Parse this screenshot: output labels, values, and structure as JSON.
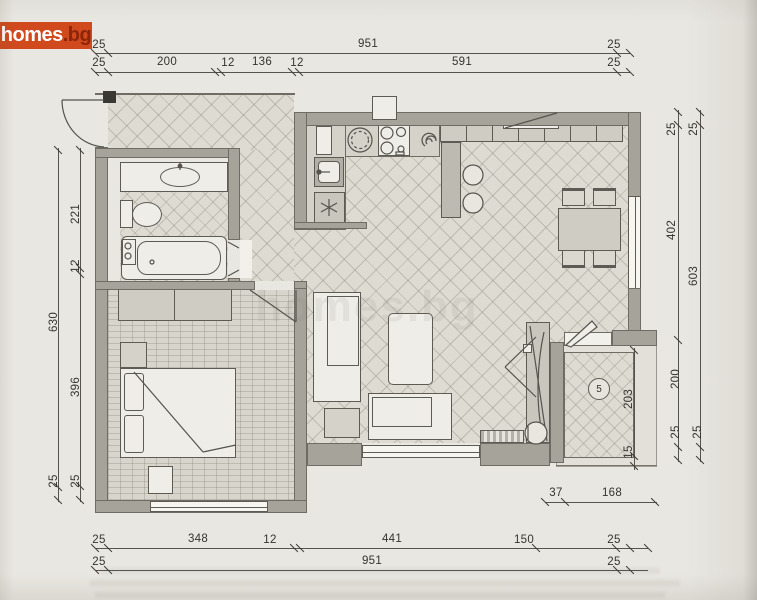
{
  "logo": {
    "main": "homes",
    "suffix": ".bg"
  },
  "watermark": "homes.bg",
  "balcony": {
    "label": "5"
  },
  "palette": {
    "paper": "#e9e7e1",
    "wall": "#a6a39a",
    "line": "#55534c",
    "logo_bg": "#d04a1d",
    "logo_text": "#ffffff",
    "logo_suffix": "#8e2509",
    "floor_tile": "#dedbd3",
    "floor_parquet": "#d8d5cd"
  },
  "icons": {
    "washer-icon": "asterisk",
    "extractor-icon": "spiral",
    "stove-icon": "four burner circles",
    "kitchen-round-sink-icon": "dashed circle",
    "boiler-icon": "small circles box",
    "balcony-number-icon": "circled number"
  },
  "dim_labels": [
    {
      "t": "25",
      "x": 99,
      "y": 45,
      "r": 0
    },
    {
      "t": "951",
      "x": 368,
      "y": 44,
      "r": 0
    },
    {
      "t": "25",
      "x": 614,
      "y": 45,
      "r": 0
    },
    {
      "t": "25",
      "x": 99,
      "y": 63,
      "r": 0
    },
    {
      "t": "200",
      "x": 167,
      "y": 62,
      "r": 0
    },
    {
      "t": "12",
      "x": 228,
      "y": 63,
      "r": 0
    },
    {
      "t": "136",
      "x": 262,
      "y": 62,
      "r": 0
    },
    {
      "t": "12",
      "x": 297,
      "y": 63,
      "r": 0
    },
    {
      "t": "591",
      "x": 462,
      "y": 62,
      "r": 0
    },
    {
      "t": "25",
      "x": 614,
      "y": 63,
      "r": 0
    },
    {
      "t": "25",
      "x": 99,
      "y": 540,
      "r": 0
    },
    {
      "t": "348",
      "x": 198,
      "y": 539,
      "r": 0
    },
    {
      "t": "12",
      "x": 270,
      "y": 540,
      "r": 0
    },
    {
      "t": "441",
      "x": 392,
      "y": 539,
      "r": 0
    },
    {
      "t": "150",
      "x": 524,
      "y": 540,
      "r": 0
    },
    {
      "t": "25",
      "x": 614,
      "y": 540,
      "r": 0
    },
    {
      "t": "25",
      "x": 99,
      "y": 562,
      "r": 0
    },
    {
      "t": "951",
      "x": 372,
      "y": 561,
      "r": 0
    },
    {
      "t": "25",
      "x": 614,
      "y": 562,
      "r": 0
    },
    {
      "t": "37",
      "x": 556,
      "y": 493,
      "r": 0
    },
    {
      "t": "168",
      "x": 612,
      "y": 493,
      "r": 0
    },
    {
      "t": "221",
      "x": 76,
      "y": 214,
      "r": -90
    },
    {
      "t": "12",
      "x": 76,
      "y": 266,
      "r": -90
    },
    {
      "t": "630",
      "x": 54,
      "y": 322,
      "r": -90
    },
    {
      "t": "396",
      "x": 76,
      "y": 387,
      "r": -90
    },
    {
      "t": "25",
      "x": 54,
      "y": 481,
      "r": -90
    },
    {
      "t": "25",
      "x": 76,
      "y": 481,
      "r": -90
    },
    {
      "t": "25",
      "x": 672,
      "y": 129,
      "r": -90
    },
    {
      "t": "25",
      "x": 694,
      "y": 129,
      "r": -90
    },
    {
      "t": "402",
      "x": 672,
      "y": 230,
      "r": -90
    },
    {
      "t": "603",
      "x": 694,
      "y": 276,
      "r": -90
    },
    {
      "t": "200",
      "x": 676,
      "y": 379,
      "r": -90
    },
    {
      "t": "25",
      "x": 676,
      "y": 432,
      "r": -90
    },
    {
      "t": "25",
      "x": 698,
      "y": 432,
      "r": -90
    },
    {
      "t": "203",
      "x": 629,
      "y": 399,
      "r": -90
    },
    {
      "t": "15",
      "x": 629,
      "y": 452,
      "r": -90
    }
  ],
  "dim_lines": [
    {
      "o": "h",
      "x": 95,
      "y": 53,
      "len": 535
    },
    {
      "o": "h",
      "x": 95,
      "y": 72,
      "len": 535
    },
    {
      "o": "h",
      "x": 95,
      "y": 548,
      "len": 553
    },
    {
      "o": "h",
      "x": 95,
      "y": 570,
      "len": 553
    },
    {
      "o": "h",
      "x": 545,
      "y": 502,
      "len": 112
    },
    {
      "o": "v",
      "x": 58,
      "y": 148,
      "len": 354
    },
    {
      "o": "v",
      "x": 80,
      "y": 148,
      "len": 354
    },
    {
      "o": "v",
      "x": 678,
      "y": 110,
      "len": 352
    },
    {
      "o": "v",
      "x": 700,
      "y": 110,
      "len": 352
    },
    {
      "o": "v",
      "x": 634,
      "y": 348,
      "len": 122
    }
  ],
  "ticks": [
    {
      "x": 95,
      "y": 53
    },
    {
      "x": 108,
      "y": 53
    },
    {
      "x": 617,
      "y": 53
    },
    {
      "x": 630,
      "y": 53
    },
    {
      "x": 95,
      "y": 72
    },
    {
      "x": 108,
      "y": 72
    },
    {
      "x": 215,
      "y": 72
    },
    {
      "x": 221,
      "y": 72
    },
    {
      "x": 292,
      "y": 72
    },
    {
      "x": 299,
      "y": 72
    },
    {
      "x": 617,
      "y": 72
    },
    {
      "x": 630,
      "y": 72
    },
    {
      "x": 95,
      "y": 548
    },
    {
      "x": 108,
      "y": 548
    },
    {
      "x": 294,
      "y": 548
    },
    {
      "x": 300,
      "y": 548
    },
    {
      "x": 536,
      "y": 548
    },
    {
      "x": 616,
      "y": 548
    },
    {
      "x": 630,
      "y": 548
    },
    {
      "x": 648,
      "y": 548
    },
    {
      "x": 95,
      "y": 570
    },
    {
      "x": 108,
      "y": 570
    },
    {
      "x": 617,
      "y": 570
    },
    {
      "x": 630,
      "y": 570
    },
    {
      "x": 545,
      "y": 502
    },
    {
      "x": 565,
      "y": 502
    },
    {
      "x": 655,
      "y": 502
    },
    {
      "x": 58,
      "y": 150
    },
    {
      "x": 58,
      "y": 487
    },
    {
      "x": 58,
      "y": 500
    },
    {
      "x": 80,
      "y": 150
    },
    {
      "x": 80,
      "y": 268
    },
    {
      "x": 80,
      "y": 274
    },
    {
      "x": 80,
      "y": 486
    },
    {
      "x": 80,
      "y": 500
    },
    {
      "x": 678,
      "y": 112
    },
    {
      "x": 678,
      "y": 125
    },
    {
      "x": 678,
      "y": 340
    },
    {
      "x": 678,
      "y": 447
    },
    {
      "x": 678,
      "y": 460
    },
    {
      "x": 700,
      "y": 112
    },
    {
      "x": 700,
      "y": 125
    },
    {
      "x": 700,
      "y": 447
    },
    {
      "x": 700,
      "y": 460
    },
    {
      "x": 634,
      "y": 350
    },
    {
      "x": 634,
      "y": 456
    },
    {
      "x": 634,
      "y": 466
    }
  ]
}
